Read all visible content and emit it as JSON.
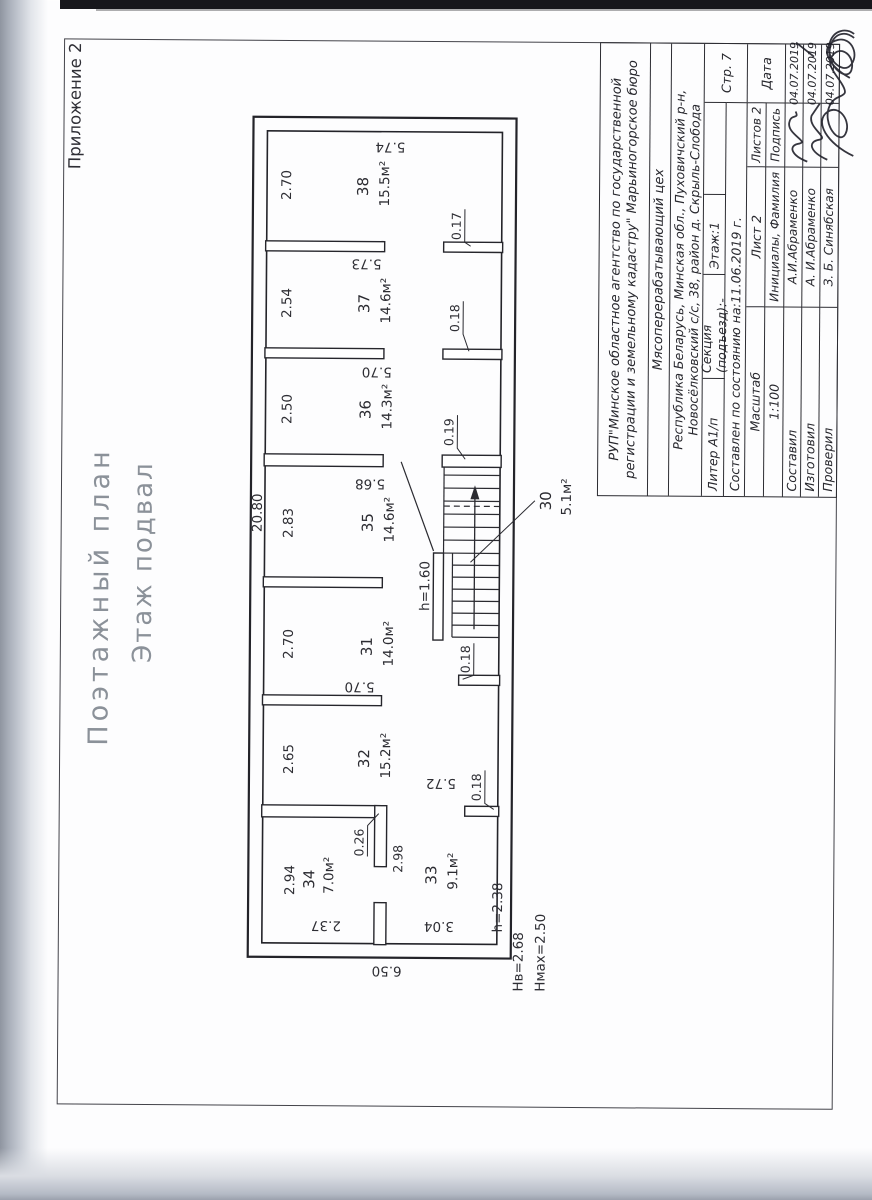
{
  "page": {
    "appendix_note": "Приложение 2",
    "plan_title": "Поэтажный план",
    "plan_subtitle": "Этаж подвал"
  },
  "plan": {
    "total_length": "20.80",
    "total_depth": "6.50",
    "rooms": [
      {
        "number": "30",
        "area": "5.1м²"
      },
      {
        "number": "31",
        "area": "14.0м²"
      },
      {
        "number": "32",
        "area": "15.2м²"
      },
      {
        "number": "33",
        "area": "9.1м²"
      },
      {
        "number": "34",
        "area": "7.0м²"
      },
      {
        "number": "35",
        "area": "14.6м²"
      },
      {
        "number": "36",
        "area": "14.3м²"
      },
      {
        "number": "37",
        "area": "14.6м²"
      },
      {
        "number": "38",
        "area": "15.5м²"
      }
    ],
    "width_dims": [
      "2.94",
      "2.65",
      "2.70",
      "2.83",
      "2.50",
      "2.54",
      "2.70"
    ],
    "depth_dims": [
      "5.72",
      "5.70",
      "5.68",
      "5.70",
      "5.73",
      "5.74"
    ],
    "side_dims": [
      "2.37",
      "3.04"
    ],
    "wall_dims": [
      "0.26",
      "2.98"
    ],
    "stub_dims": [
      "0.18",
      "0.18",
      "0.19",
      "0.18",
      "0.17"
    ],
    "height_notes": [
      "h=2.38",
      "h=1.60"
    ],
    "ceiling_heights": [
      "Hв=2.68",
      "Hмах=2.50"
    ]
  },
  "title_block": {
    "agency_line1": "РУП\"Минское областное агентство по государственной",
    "agency_line2": "регистрации и земельному кадастру\" Марьиногорское бюро",
    "object_name": "Мясоперерабатывающий цех",
    "address_line1": "Республика Беларусь, Минская обл., Пуховичский р-н,",
    "address_line2": "Новосёлковский с/с, 38, район д. Скрыль-Слобода",
    "liter_label": "Литер А1/п",
    "section_label": "Секция (подъезд):-",
    "floor_label": "Этаж:1",
    "composed_label": "Составлен по состоянию на:11.06.2019 г.",
    "scale_label": "Масштаб",
    "scale_value": "1:100",
    "sheet_label": "Лист  2",
    "sheets_label": "Листов 2",
    "page_label": "Стр.  7",
    "name_header": "Инициалы, Фамилия",
    "sign_header": "Подпись",
    "date_header": "Дата",
    "rows": [
      {
        "role": "Составил",
        "name": "А.И.Абраменко",
        "date": "04.07.2019"
      },
      {
        "role": "Изготовил",
        "name": "А. И.Абраменко",
        "date": "04.07.2019"
      },
      {
        "role": "Проверил",
        "name": "З. Б. Синябская",
        "date": "04.07.2019"
      }
    ]
  }
}
